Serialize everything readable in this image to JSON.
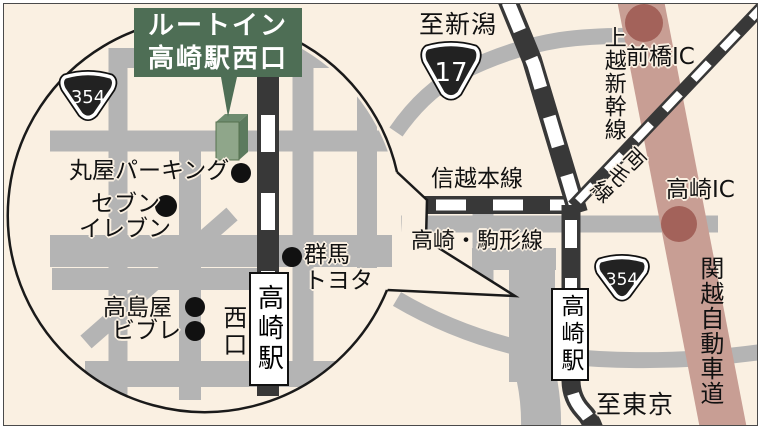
{
  "callout": {
    "line1": "ルートイン",
    "line2": "高崎駅西口"
  },
  "shields": {
    "r354_circle": "354",
    "r17": "17",
    "r354_overview": "354"
  },
  "circle_area": {
    "maruya_parking": "丸屋パーキング",
    "seven": "セブン",
    "eleven": "イレブン",
    "gunma": "群馬",
    "toyota": "トヨタ",
    "takashimaya": "高島屋",
    "vivre": "ビブレ",
    "west_exit": "西口",
    "station": "高崎駅"
  },
  "overview": {
    "to_niigata": "至新潟",
    "shinetsu_line": "信越本線",
    "joetsu_shinkansen": "上越新幹線",
    "ryomo_line": "両毛線",
    "maebashi_ic": "前橋IC",
    "takasaki_ic": "高崎IC",
    "komagata_line": "高崎・駒形線",
    "kanetsu_expressway": "関越自動車道",
    "station": "高崎駅",
    "to_tokyo": "至東京"
  },
  "colors": {
    "background": "#faf0e2",
    "road_gray": "#b4b4b4",
    "railway_dark": "#383838",
    "outline_black": "#1a1a1a",
    "callout_green": "#4e6e55",
    "building_front": "#8fa68a",
    "building_side": "#5c7a5e",
    "building_top": "#6e8c6f",
    "expressway_pink": "#c89e94",
    "interchange_brown": "#a3625a",
    "station_box_white": "#ffffff",
    "text_black": "#111111"
  }
}
